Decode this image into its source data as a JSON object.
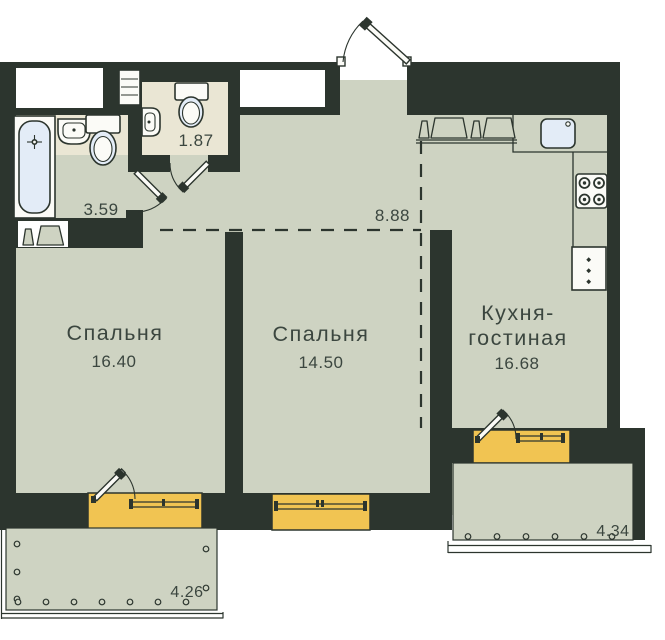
{
  "rooms": {
    "bedroom_left": {
      "label": "Спальня",
      "area": "16.40"
    },
    "bedroom_middle": {
      "label": "Спальня",
      "area": "14.50"
    },
    "kitchen_living": {
      "label_line1": "Кухня-",
      "label_line2": "гостиная",
      "area": "16.68"
    },
    "bathroom": {
      "area": "3.59"
    },
    "wc": {
      "area": "1.87"
    },
    "hallway": {
      "area": "8.88"
    },
    "balcony_left": {
      "area": "4.26"
    },
    "balcony_right": {
      "area": "4.34"
    }
  },
  "fixtures": [
    "bathtub",
    "sink",
    "toilet",
    "washing-machine",
    "water-heater-shelf",
    "kitchen-counter",
    "kitchen-sink",
    "stove",
    "fridge",
    "entrance-door",
    "interior-door",
    "balcony-door",
    "window"
  ],
  "colors": {
    "wall": "#2c352e",
    "floor": "#ced3c2",
    "wet_zone": "#eae6d4",
    "window_frame": "#f1c452",
    "sanitary": "#e3ecf7",
    "text": "#3b463f",
    "background": "#ffffff"
  }
}
